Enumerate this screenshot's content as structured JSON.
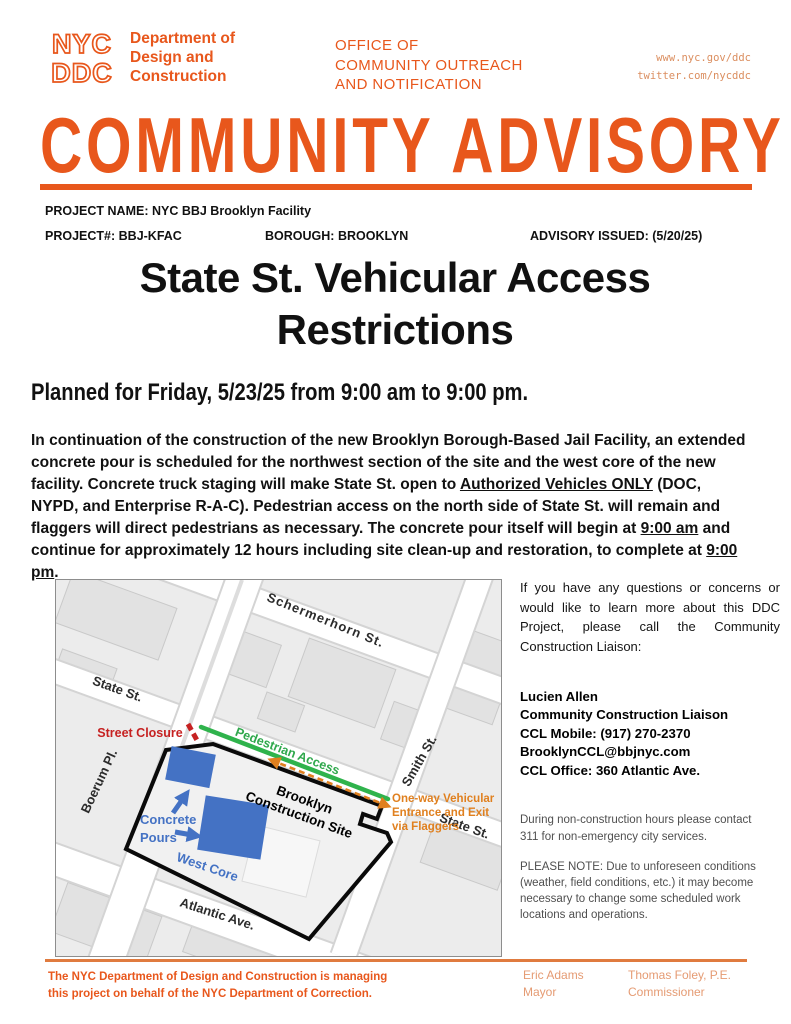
{
  "header": {
    "logo": {
      "line1": "NYC",
      "line2": "DDC"
    },
    "agency_lines": [
      "Department of",
      "Design and",
      "Construction"
    ],
    "office_lines": [
      "OFFICE OF",
      "COMMUNITY OUTREACH",
      "AND NOTIFICATION"
    ],
    "links": [
      "www.nyc.gov/ddc",
      "twitter.com/nycddc"
    ]
  },
  "banner": "COMMUNITY ADVISORY",
  "project": {
    "name_label": "PROJECT NAME:",
    "name": "NYC BBJ Brooklyn Facility",
    "number_label": "PROJECT#:",
    "number": "BBJ-KFAC",
    "borough_label": "BOROUGH:",
    "borough": "BROOKLYN",
    "issued_label": "ADVISORY ISSUED:",
    "issued": "(5/20/25)"
  },
  "title_line1": "State St. Vehicular Access",
  "title_line2": "Restrictions",
  "subtitle": "Planned for Friday, 5/23/25 from 9:00 am to 9:00 pm.",
  "body": {
    "segments": [
      "In continuation of the construction of the new Brooklyn Borough-Based Jail Facility, an extended concrete pour is scheduled for the northwest section of the site and the west core of the new facility. Concrete truck staging will make State St. open to ",
      "Authorized Vehicles ONLY",
      " (DOC, NYPD, and Enterprise R-A-C). Pedestrian access on the north side of State St. will remain and flaggers will direct pedestrians as necessary. The concrete pour itself will begin at ",
      "9:00 am",
      " and continue for approximately 12 hours including site clean-up and restoration, to complete at ",
      "9:00 pm",
      "."
    ]
  },
  "map": {
    "streets": {
      "schermerhorn": "Schermerhorn  St.",
      "state_left": "State St.",
      "boerum": "Boerum Pl.",
      "smith": "Smith St.",
      "state_right": "State St.",
      "atlantic": "Atlantic Ave."
    },
    "labels": {
      "street_closure": "Street Closure",
      "pedestrian_access": "Pedestrian Access",
      "one_way_1": "One-way Vehicular",
      "one_way_2": "Entrance and Exit",
      "one_way_3": "via Flaggers",
      "site_1": "Brooklyn",
      "site_2": "Construction Site",
      "concrete_1": "Concrete",
      "concrete_2": "Pours",
      "west_core": "West Core"
    },
    "colors": {
      "closure_red": "#C62222",
      "pedestrian_green": "#2FB34C",
      "vehicular_orange": "#E0801F",
      "pour_blue": "#4472C4",
      "site_outline": "#0a0a0a"
    }
  },
  "sidebar": {
    "intro": "If you have any questions or concerns or would like to learn more about this DDC Project, please call the Community Construction Liaison:",
    "contact": [
      "Lucien Allen",
      "Community Construction Liaison",
      "CCL Mobile: (917) 270-2370",
      "BrooklynCCL@bbjnyc.com",
      "CCL Office: 360 Atlantic Ave."
    ],
    "note1": "During non-construction hours please contact 311 for non-emergency city services.",
    "note2": "PLEASE NOTE: Due to unforeseen conditions (weather, field conditions, etc.) it may become necessary to change some scheduled work locations and operations."
  },
  "footer": {
    "left_lines": [
      "The NYC Department of Design and Construction is managing",
      "this project on behalf of the NYC Department of Correction."
    ],
    "mayor_name": "Eric Adams",
    "mayor_title": "Mayor",
    "commissioner_name": "Thomas Foley, P.E.",
    "commissioner_title": "Commissioner"
  },
  "colors": {
    "ddc_orange": "#E8571C",
    "link_orange": "#DB8E5F",
    "footer_muted_orange": "#E59B73"
  }
}
